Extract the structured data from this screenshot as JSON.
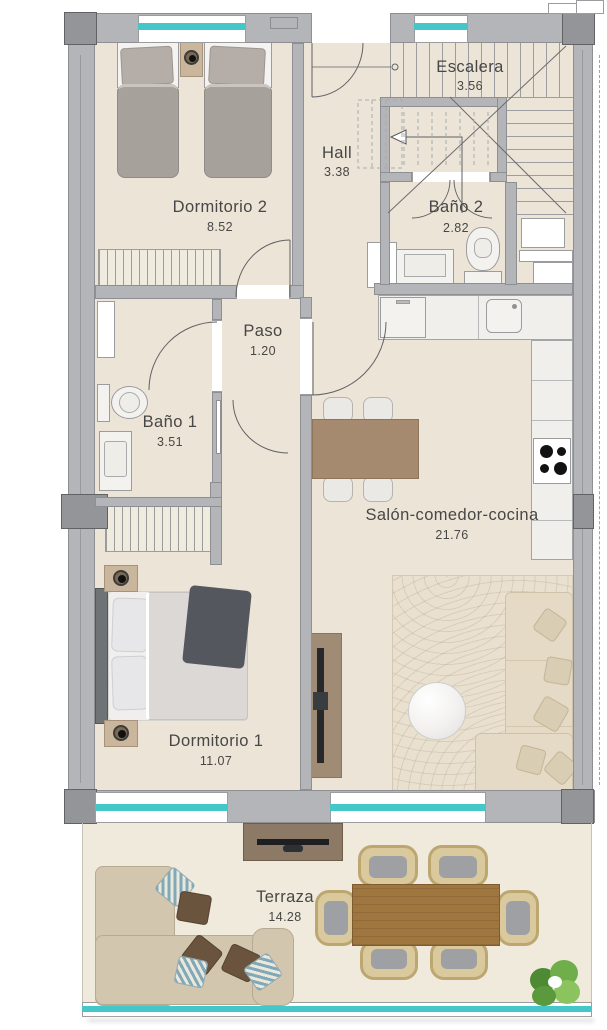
{
  "rooms": [
    {
      "name": "Dormitorio 2",
      "area": "8.52"
    },
    {
      "name": "Escalera",
      "area": "3.56"
    },
    {
      "name": "Hall",
      "area": "3.38"
    },
    {
      "name": "Baño 2",
      "area": "2.82"
    },
    {
      "name": "Paso",
      "area": "1.20"
    },
    {
      "name": "Baño 1",
      "area": "3.51"
    },
    {
      "name": "Salón-comedor-cocina",
      "area": "21.76"
    },
    {
      "name": "Dormitorio 1",
      "area": "11.07"
    },
    {
      "name": "Terraza",
      "area": "14.28"
    }
  ],
  "colors": {
    "wall": "#b3b5b8",
    "wall_dark": "#939598",
    "glass": "#45c7c9",
    "floor": "#ece4d6",
    "terrace_floor": "#f0eadd",
    "wood": "#a58a6f",
    "label_text": "#474747"
  }
}
